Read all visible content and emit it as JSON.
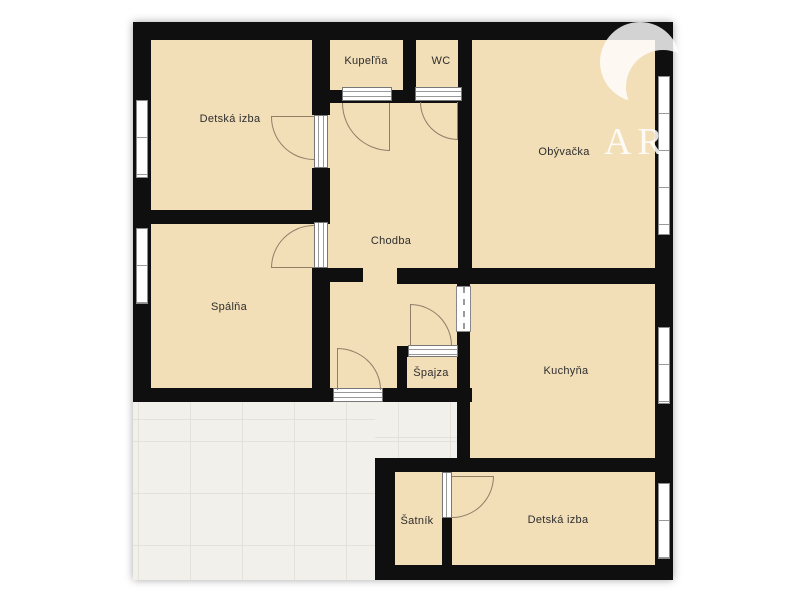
{
  "floorplan": {
    "rooms": {
      "detska_izba_top": "Detská izba",
      "kupelna": "Kupeľňa",
      "wc": "WC",
      "obyvacka": "Obývačka",
      "chodba": "Chodba",
      "spalna": "Spálňa",
      "spajza": "Špajza",
      "kuchyna": "Kuchyňa",
      "satnik": "Šatník",
      "detska_izba_bottom": "Detská izba"
    },
    "watermark": {
      "text": "AR"
    },
    "colors": {
      "room_fill": "#f2deb7",
      "wall": "#0f0f0f",
      "tile_floor": "#f1f0eb",
      "background": "#ffffff",
      "door_arc": "#8f7f68"
    }
  }
}
